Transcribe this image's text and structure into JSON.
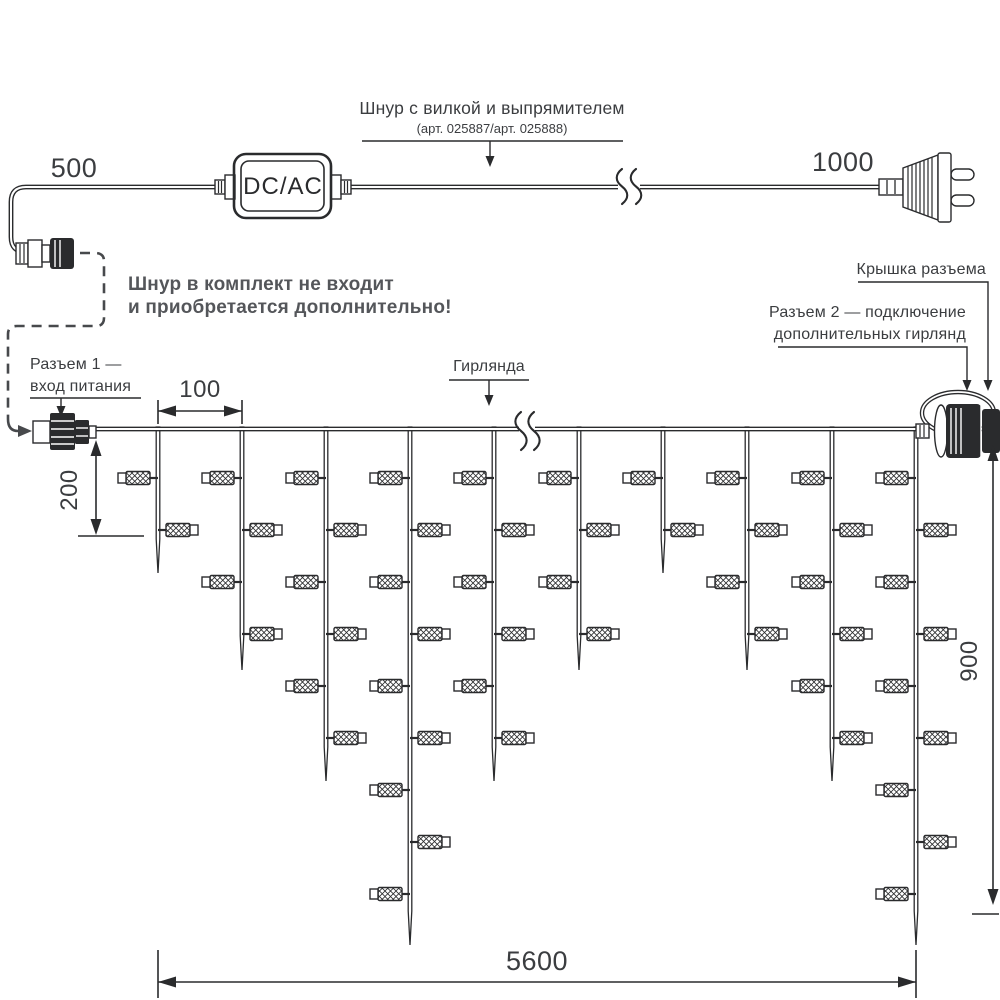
{
  "colors": {
    "line": "#2a2b2d",
    "text": "#3b3d40",
    "note_text": "#54565a",
    "dashed_line": "#47494c",
    "background": "#ffffff"
  },
  "power_section": {
    "dim_500": "500",
    "dim_1000": "1000",
    "converter": "DC/AC",
    "cord_title": "Шнур с вилкой и выпрямителем",
    "cord_subtitle": "(арт. 025887/арт. 025888)",
    "note_line1": "Шнур в комплект не входит",
    "note_line2": "и приобретается дополнительно!"
  },
  "labels": {
    "connector1_line1": "Разъем 1 —",
    "connector1_line2": "вход питания",
    "cap": "Крышка разъема",
    "connector2_line1": "Разъем 2 — подключение",
    "connector2_line2": "дополнительных гирлянд",
    "garland": "Гирлянда"
  },
  "dimensions": {
    "d100": "100",
    "d200": "200",
    "d900": "900",
    "d5600": "5600"
  },
  "garland": {
    "drops": {
      "x": [
        158,
        242,
        326,
        410,
        494,
        579,
        663,
        747,
        832,
        916
      ],
      "lights": [
        2,
        4,
        6,
        9,
        6,
        4,
        2,
        4,
        6,
        9
      ],
      "tip_y": [
        573,
        670,
        781,
        945,
        781,
        670,
        573,
        670,
        781,
        945
      ],
      "top_y": 427,
      "row_start_y": 478,
      "row_spacing": 52,
      "body_len": 24,
      "cap_len": 8,
      "stub_len": 8,
      "body_h": 13,
      "cap_h": 10
    }
  }
}
